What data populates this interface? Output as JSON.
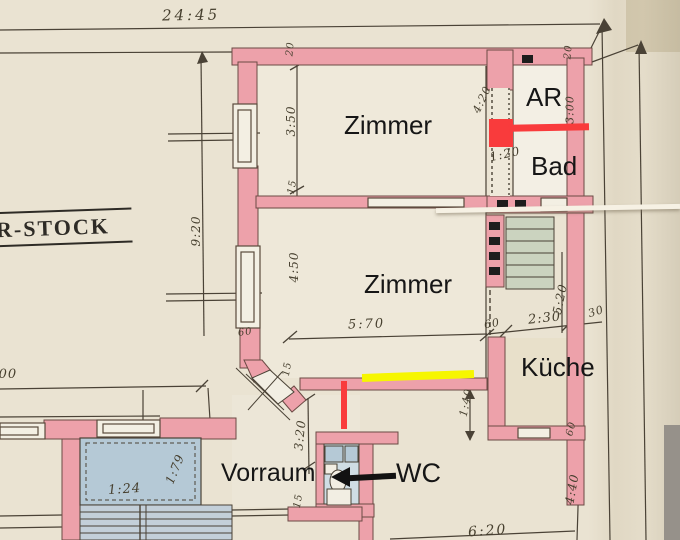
{
  "stamp": {
    "floor_label": "R-STOCK"
  },
  "rooms": {
    "zimmer_top": "Zimmer",
    "ar": "AR",
    "bad": "Bad",
    "zimmer_mid": "Zimmer",
    "kueche": "Küche",
    "vorraum": "Vorraum",
    "wc": "WC"
  },
  "dimensions": {
    "total_width": "24:45",
    "depth_left": "9:20",
    "zimmer_top_height": "3:50",
    "wall_20_top": "20",
    "wall_15_mid": "15",
    "partition_420": "4:20",
    "partition_120": "1:20",
    "arbad_width": "3:00",
    "wall_20_right": "20",
    "zimmer_mid_height": "4:50",
    "zimmer_mid_width": "5:70",
    "niche_60": "60",
    "kueche_width": "2:30",
    "wall_30": "30",
    "kueche_depth": "5:20",
    "wall_15_lower": "15",
    "door_140": "1:40",
    "vorraum_depth": "3:20",
    "wall_15_bottom": "15",
    "lift_width": "1:79",
    "lift_note": "1:24",
    "left_400": "4:00",
    "window_60": "60",
    "kueche_door_60": "60",
    "right_depth": "4:40",
    "bottom_width": "6:20"
  },
  "annotations": {
    "red_square_color": "#f93b3c",
    "red_line_color": "#f93b3c",
    "yellow_line_color": "#f6f600",
    "arrow_color": "#121212"
  },
  "palette": {
    "paper": "#eae3d2",
    "paper_dark": "#e0d7c0",
    "wall_pink": "#eda1aa",
    "wall_outline": "#6b4a44",
    "ink": "#4a4236",
    "lift_blue": "#b5c9d6",
    "stair_green": "#cbd3bf"
  }
}
